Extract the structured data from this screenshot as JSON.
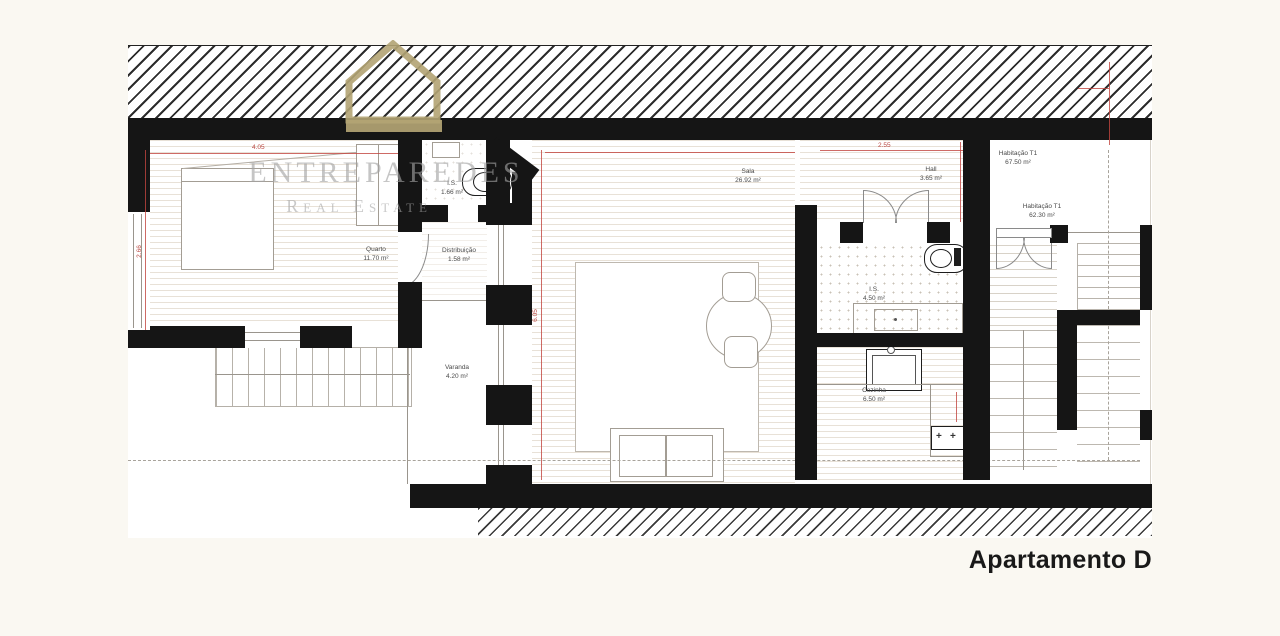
{
  "title": "Apartamento D",
  "watermark": {
    "brand": "ENTREPAREDES",
    "tagline": "Real Estate",
    "logo": "house-outline-icon",
    "logo_color": "#B3A474",
    "text_color": "#A3A3A3"
  },
  "rooms": [
    {
      "id": "quarto",
      "name": "Quarto",
      "area": "11.70 m²"
    },
    {
      "id": "is-1",
      "name": "I.S.",
      "area": "1.66 m²"
    },
    {
      "id": "distribuicao",
      "name": "Distribuição",
      "area": "1.58 m²"
    },
    {
      "id": "varanda",
      "name": "Varanda",
      "area": "4.20 m²"
    },
    {
      "id": "sala",
      "name": "Sala",
      "area": "26.92 m²"
    },
    {
      "id": "hall",
      "name": "Hall",
      "area": "3.65 m²"
    },
    {
      "id": "is-2",
      "name": "I.S.",
      "area": "4.50 m²"
    },
    {
      "id": "cozinha",
      "name": "Cozinha",
      "area": "6.50 m²"
    },
    {
      "id": "habitacao-t1-a",
      "name": "Habitação T1",
      "area": "67.50 m²"
    },
    {
      "id": "habitacao-t1-b",
      "name": "Habitação T1",
      "area": "62.30 m²"
    }
  ],
  "dimensions": {
    "quarto_width": "4.05",
    "quarto_height": "2.66",
    "sala_height": "6.05",
    "hall_width": "2.55"
  },
  "icons": {
    "burner": "+"
  },
  "colors": {
    "background": "#FAF8F2",
    "paper": "#FFFFFF",
    "wall": "#151515",
    "dimension_red": "#C2453F",
    "floor_line": "#E8E1D7",
    "title_text": "#191919"
  }
}
